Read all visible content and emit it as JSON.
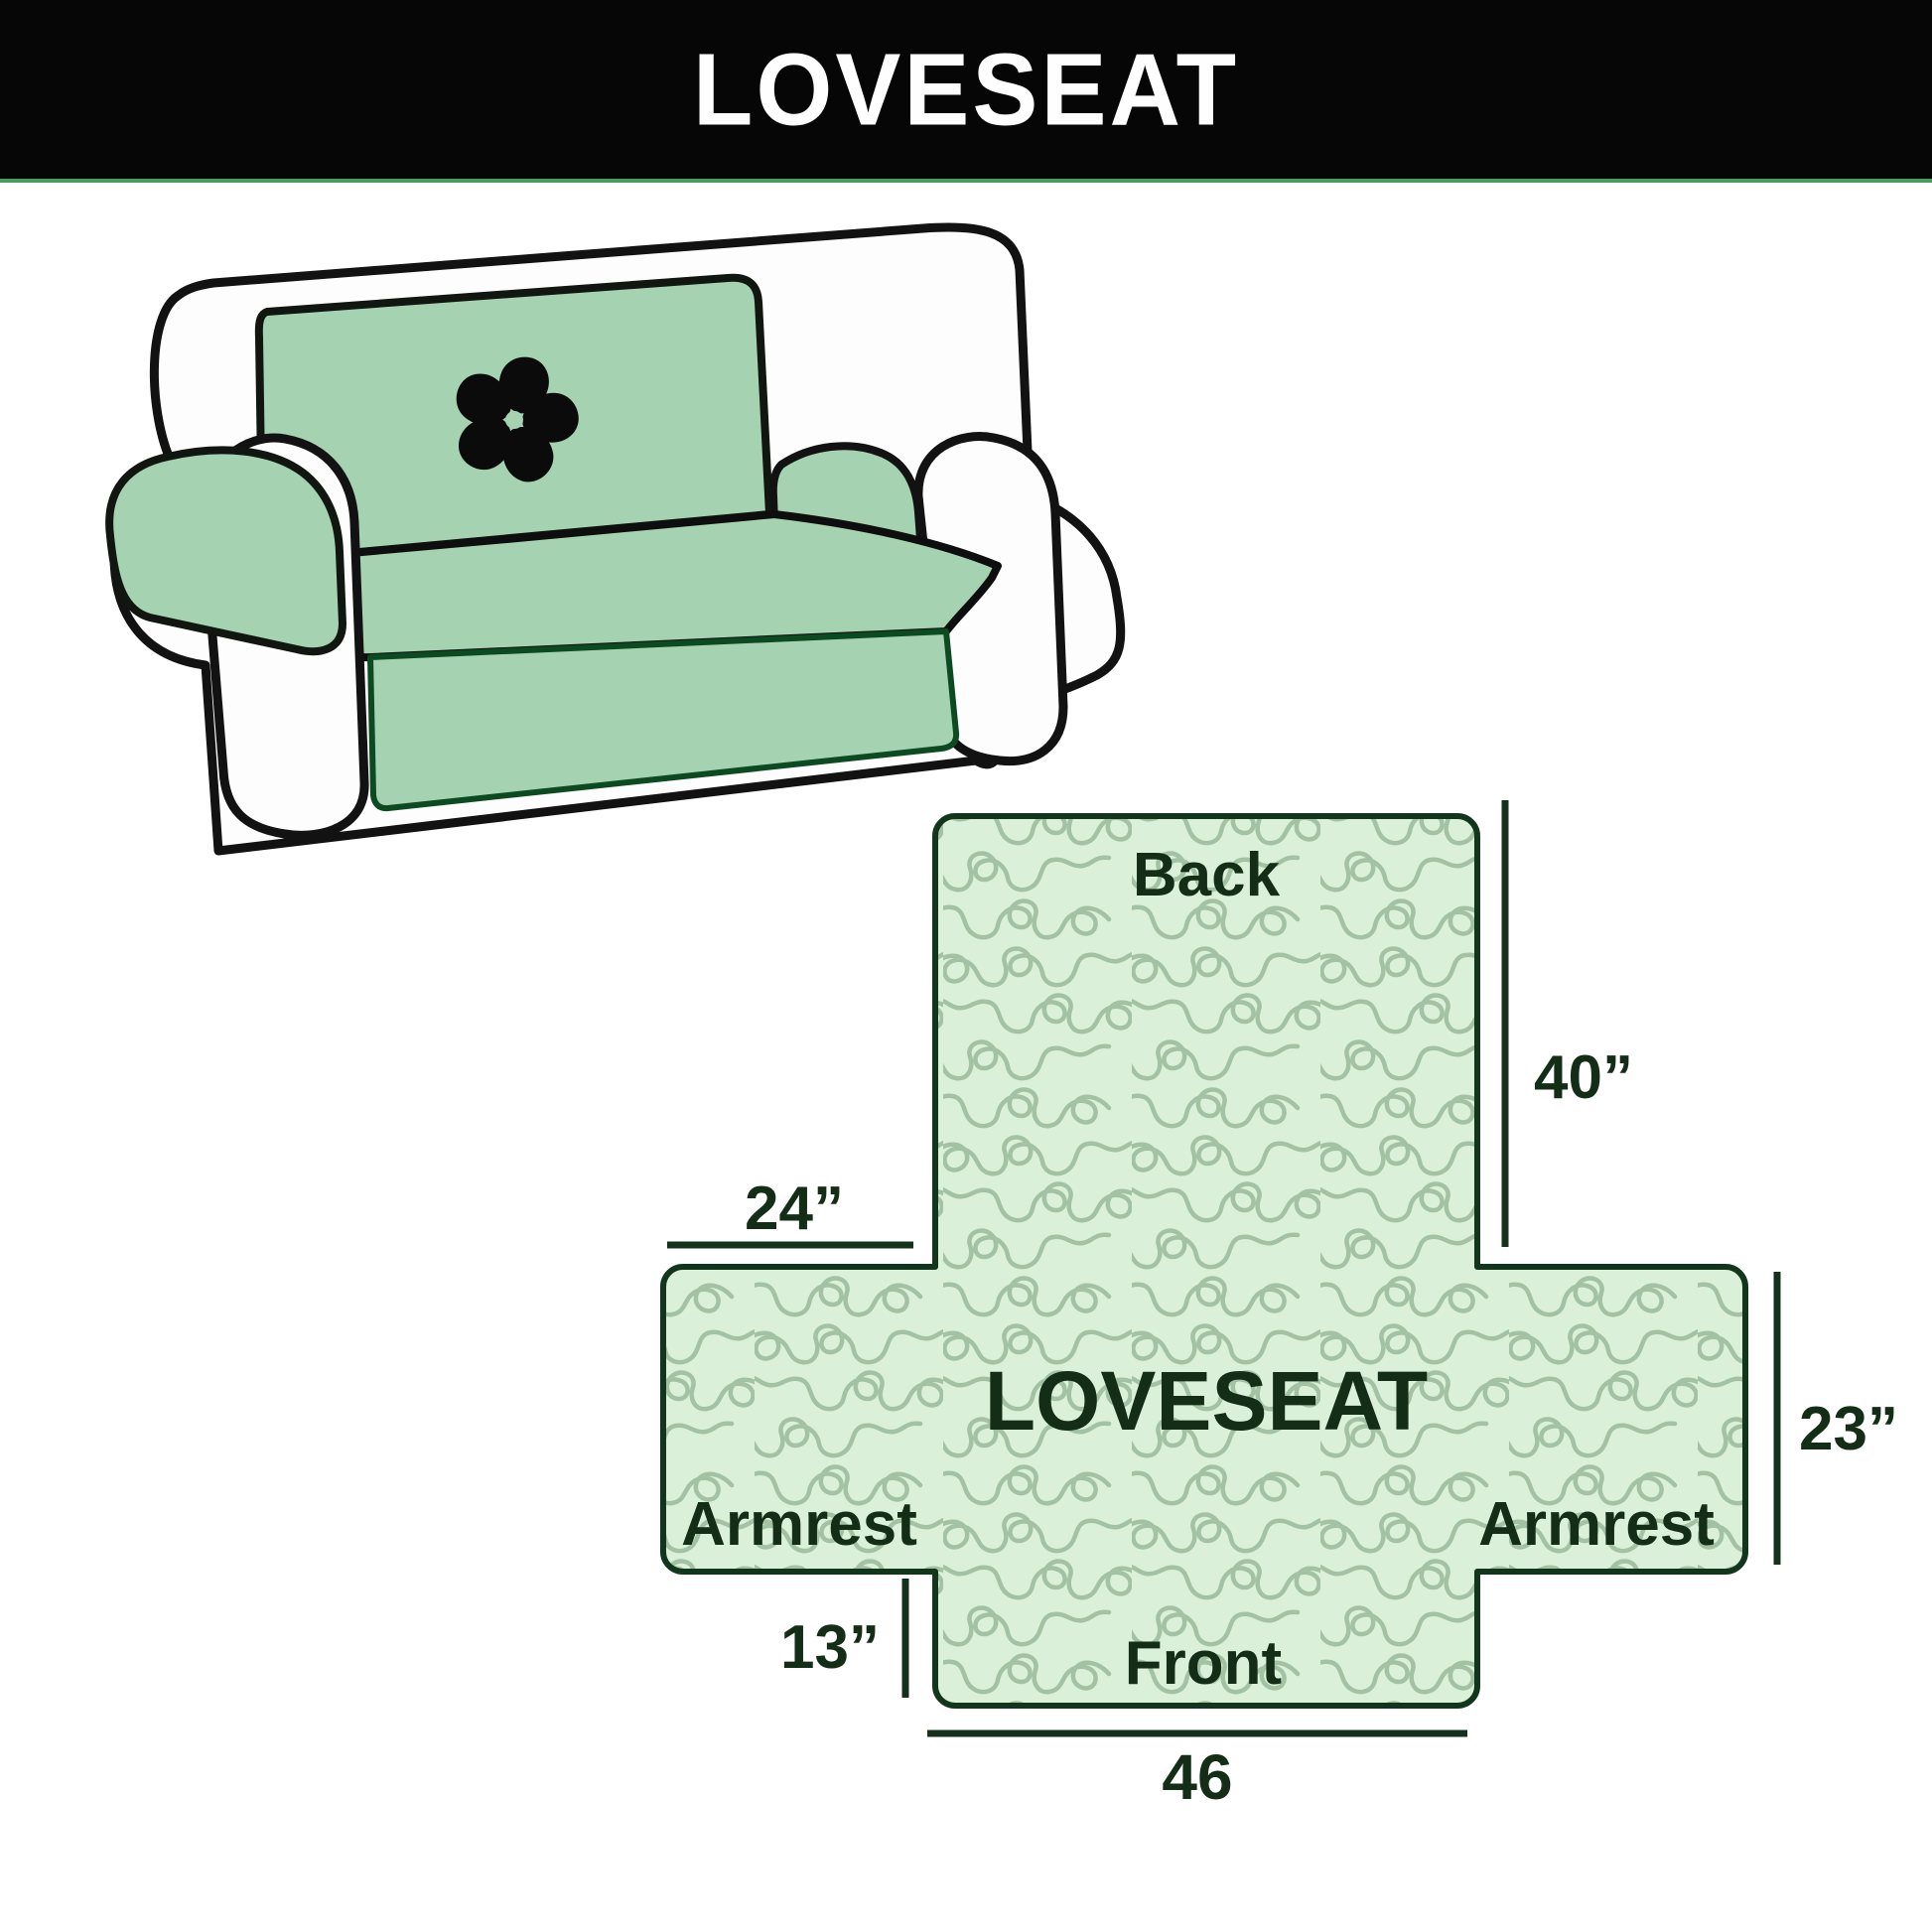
{
  "banner": {
    "title": "LOVESEAT"
  },
  "sofa": {
    "logo_icon": "pinwheel-icon"
  },
  "diagram": {
    "back_label": "Back",
    "center_label": "LOVESEAT",
    "left_armrest_label": "Armrest",
    "right_armrest_label": "Armrest",
    "front_label": "Front",
    "dimensions": {
      "back_height": "40”",
      "armrest_top_width": "24”",
      "armrest_side_height": "23”",
      "front_flap_height": "13”",
      "front_width": "46"
    }
  },
  "colors": {
    "banner_bg": "#060606",
    "banner_text": "#fefefe",
    "banner_underline": "#44a05e",
    "fabric_fill": "#daf0d8",
    "fabric_pattern_line": "#a3c2a4",
    "diagram_outline": "#12361c",
    "label_text": "#132d17",
    "sofa_cover_green": "#a5d3b2",
    "sofa_cover_edge": "#0c4a21",
    "sofa_outline": "#121212",
    "background": "#ffffff"
  }
}
